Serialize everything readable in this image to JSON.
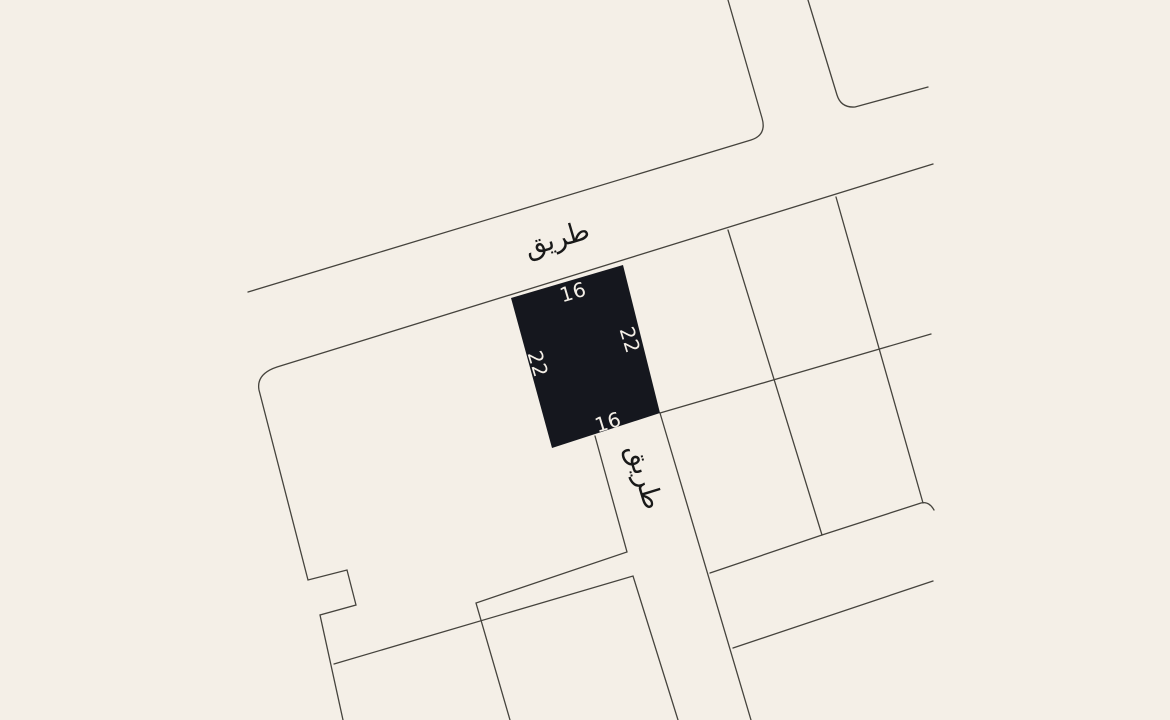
{
  "canvas": {
    "width": 1170,
    "height": 720,
    "background": "#f4efe7"
  },
  "map": {
    "stroke_color": "#45433d",
    "stroke_width": 1.3,
    "boundaries": [
      {
        "name": "top-road-upper-edge-and-north-road-west-edge",
        "d": "M 728 0 L 762 118 Q 767 135 751 140 L 248 292"
      },
      {
        "name": "north-road-east-edge-and-upper-edge-east",
        "d": "M 808 0 L 837 95 Q 841 108 855 107 L 928 87"
      },
      {
        "name": "top-road-lower-edge-and-west-block-boundary",
        "d": "M 933 164 L 277 367 Q 256 374 259 390 L 308 580 L 347 570 L 356 605 L 320 615 L 343 720"
      },
      {
        "name": "southwest-block-north-boundary",
        "d": "M 334 664 L 633 576 L 678 720"
      },
      {
        "name": "south-road-west-edge",
        "d": "M 595 436 L 627 552 L 476 603 L 510 720"
      },
      {
        "name": "south-road-east-edge",
        "d": "M 660 413 L 751 720"
      },
      {
        "name": "east-block-south-boundary",
        "d": "M 710 573 L 822 535 L 921 503 Q 929 501 934 510"
      },
      {
        "name": "southeast-road-south-edge",
        "d": "M 733 648 L 933 581"
      },
      {
        "name": "parcel-divider-east-1",
        "d": "M 728 230 L 822 535"
      },
      {
        "name": "parcel-divider-east-2",
        "d": "M 836 197 L 923 503"
      },
      {
        "name": "parcel-back-line-east",
        "d": "M 660 413 L 931 334"
      }
    ],
    "plot": {
      "fill": "#15171e",
      "points": "511,298 623,265 660,413 552,448",
      "dimension_color": "#f4efe7",
      "dimension_font_size": 20,
      "dimensions": [
        {
          "side": "north",
          "text": "16",
          "x": 573,
          "y": 292,
          "rotate": -16.5
        },
        {
          "side": "east",
          "text": "22",
          "x": 630,
          "y": 340,
          "rotate": 73
        },
        {
          "side": "west",
          "text": "22",
          "x": 538,
          "y": 364,
          "rotate": 73
        },
        {
          "side": "south",
          "text": "16",
          "x": 608,
          "y": 422,
          "rotate": -17
        }
      ]
    },
    "road_labels": {
      "color": "#191919",
      "font_size": 27,
      "items": [
        {
          "id": "road-label-top",
          "text": "طريق",
          "x": 557,
          "y": 239,
          "rotate": -16.5
        },
        {
          "id": "road-label-south",
          "text": "طريق",
          "x": 644,
          "y": 477,
          "rotate": 73
        }
      ]
    }
  }
}
